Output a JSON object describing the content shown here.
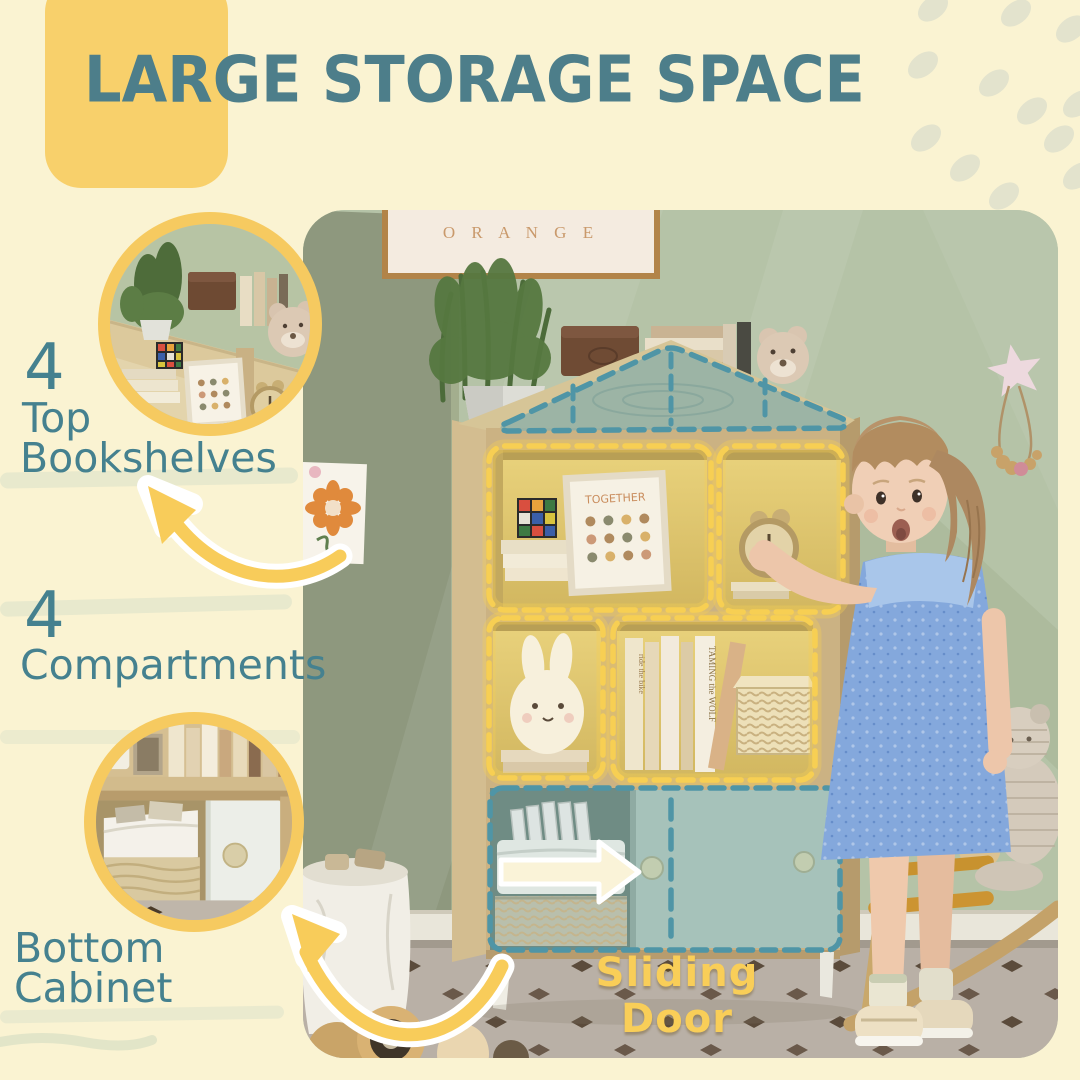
{
  "title": {
    "text": "LARGE STORAGE SPACE"
  },
  "features": [
    {
      "number": "4",
      "line1": "Top",
      "line2": "Bookshelves"
    },
    {
      "number": "4",
      "line1": "Compartments"
    },
    {
      "line1": "Bottom",
      "line2": "Cabinet"
    }
  ],
  "photo": {
    "sliding_door_label": "Sliding Door",
    "wall_frame_text": "O R A N G E",
    "shelf_frame_text": "TOGETHER",
    "book_spine_1": "TAMING the WOLF",
    "book_spine_2": "ride the bike"
  },
  "colors": {
    "background": "#FAF3D2",
    "title_teal": "#4D7E8A",
    "label_teal": "#45818F",
    "accent_yellow": "#F8D06B",
    "dash_yellow": "#F7CF53",
    "dash_teal": "#4F95A6",
    "wall_green": "#B5C3A7",
    "wood": "#CBB283",
    "door_teal": "#A6C2BA",
    "dress_blue": "#84A8DC"
  }
}
